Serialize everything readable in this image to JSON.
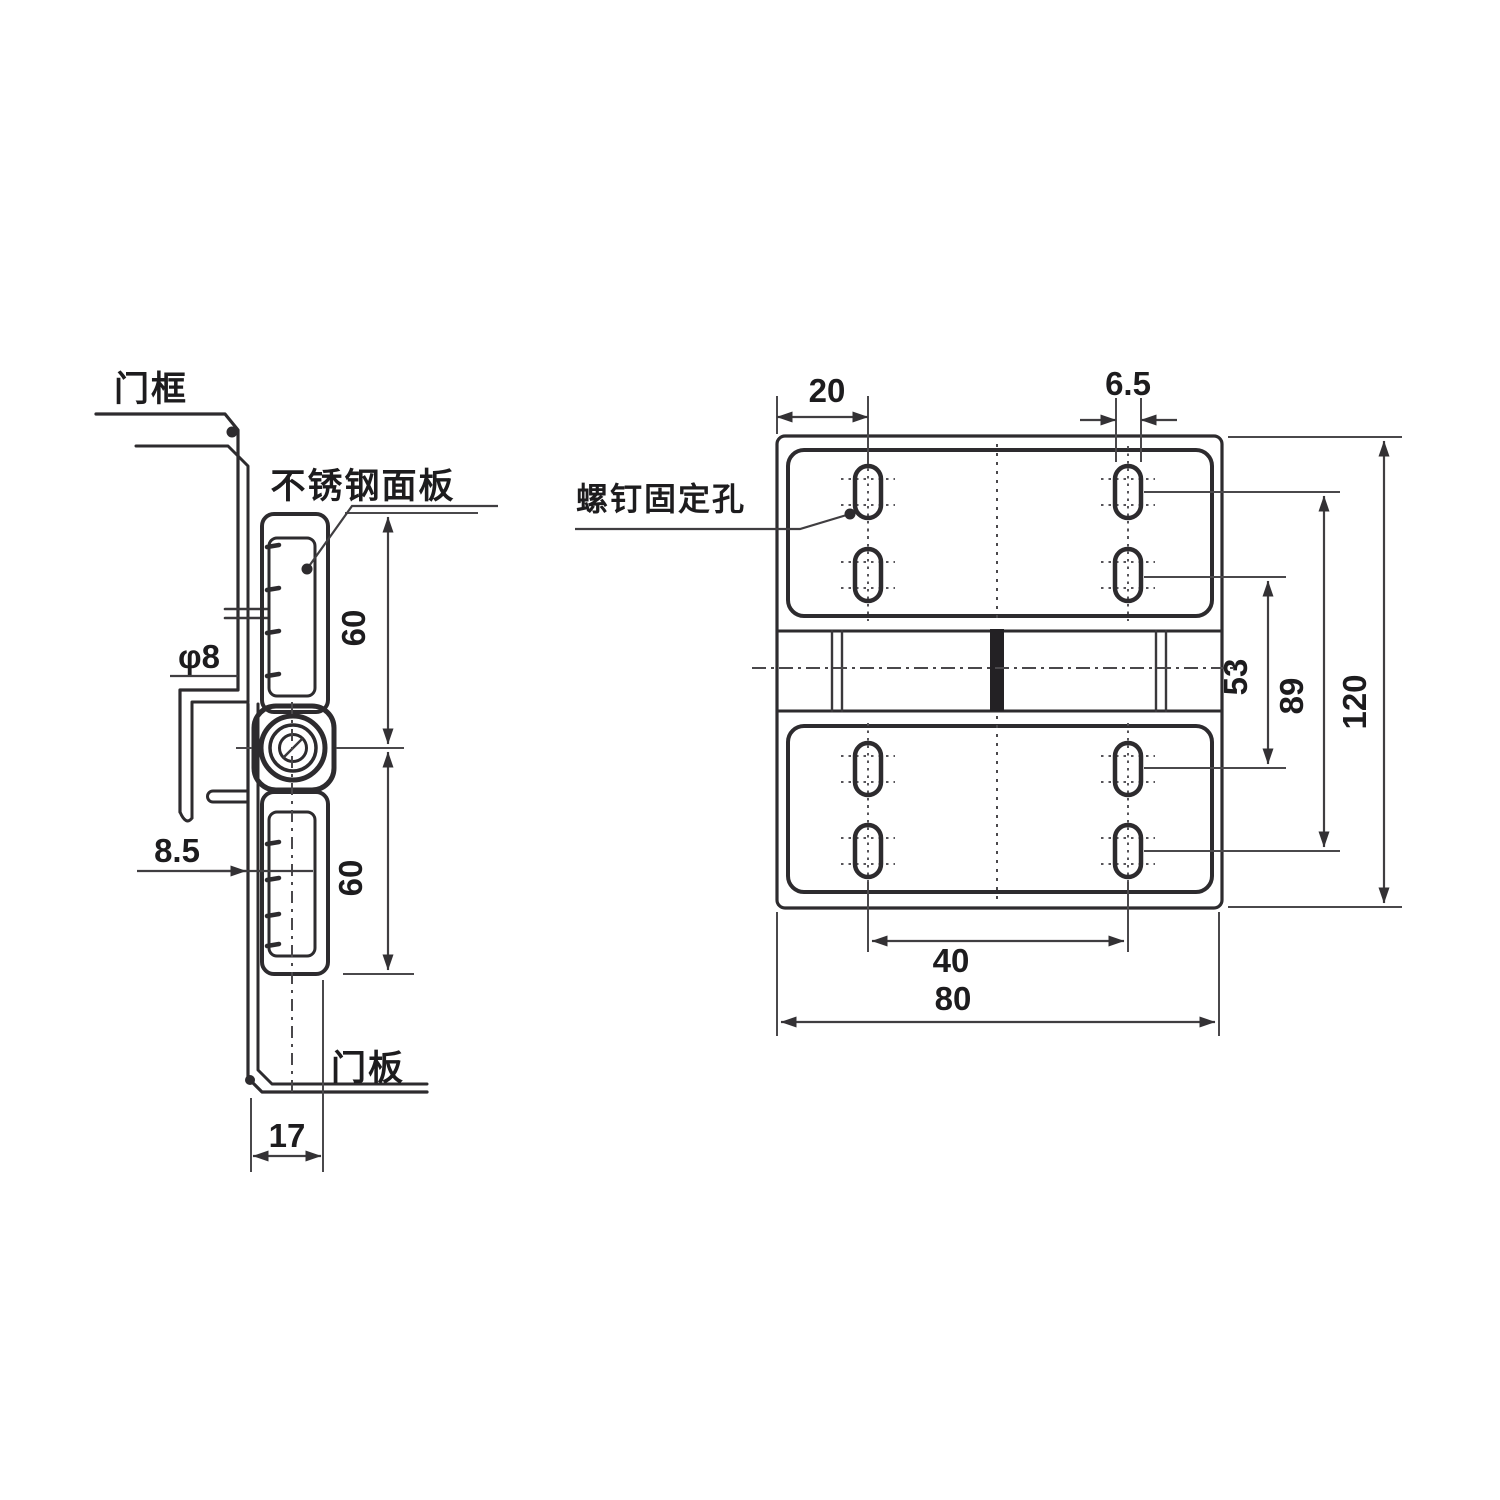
{
  "colors": {
    "background": "#ffffff",
    "outline": "#2d2b2e",
    "dimension": "#403e41"
  },
  "side_view": {
    "labels": {
      "door_frame": "门框",
      "stainless_panel": "不锈钢面板",
      "door_panel": "门板"
    },
    "dimensions": {
      "pin_diameter": "φ8",
      "offset": "8.5",
      "upper_height": "60",
      "lower_height": "60",
      "depth": "17"
    }
  },
  "front_view": {
    "labels": {
      "screw_holes": "螺钉固定孔"
    },
    "dimensions": {
      "edge_to_hole": "20",
      "slot_width": "6.5",
      "inner_hole_span": "53",
      "outer_hole_span": "89",
      "total_height": "120",
      "hole_spacing": "40",
      "total_width": "80"
    }
  }
}
